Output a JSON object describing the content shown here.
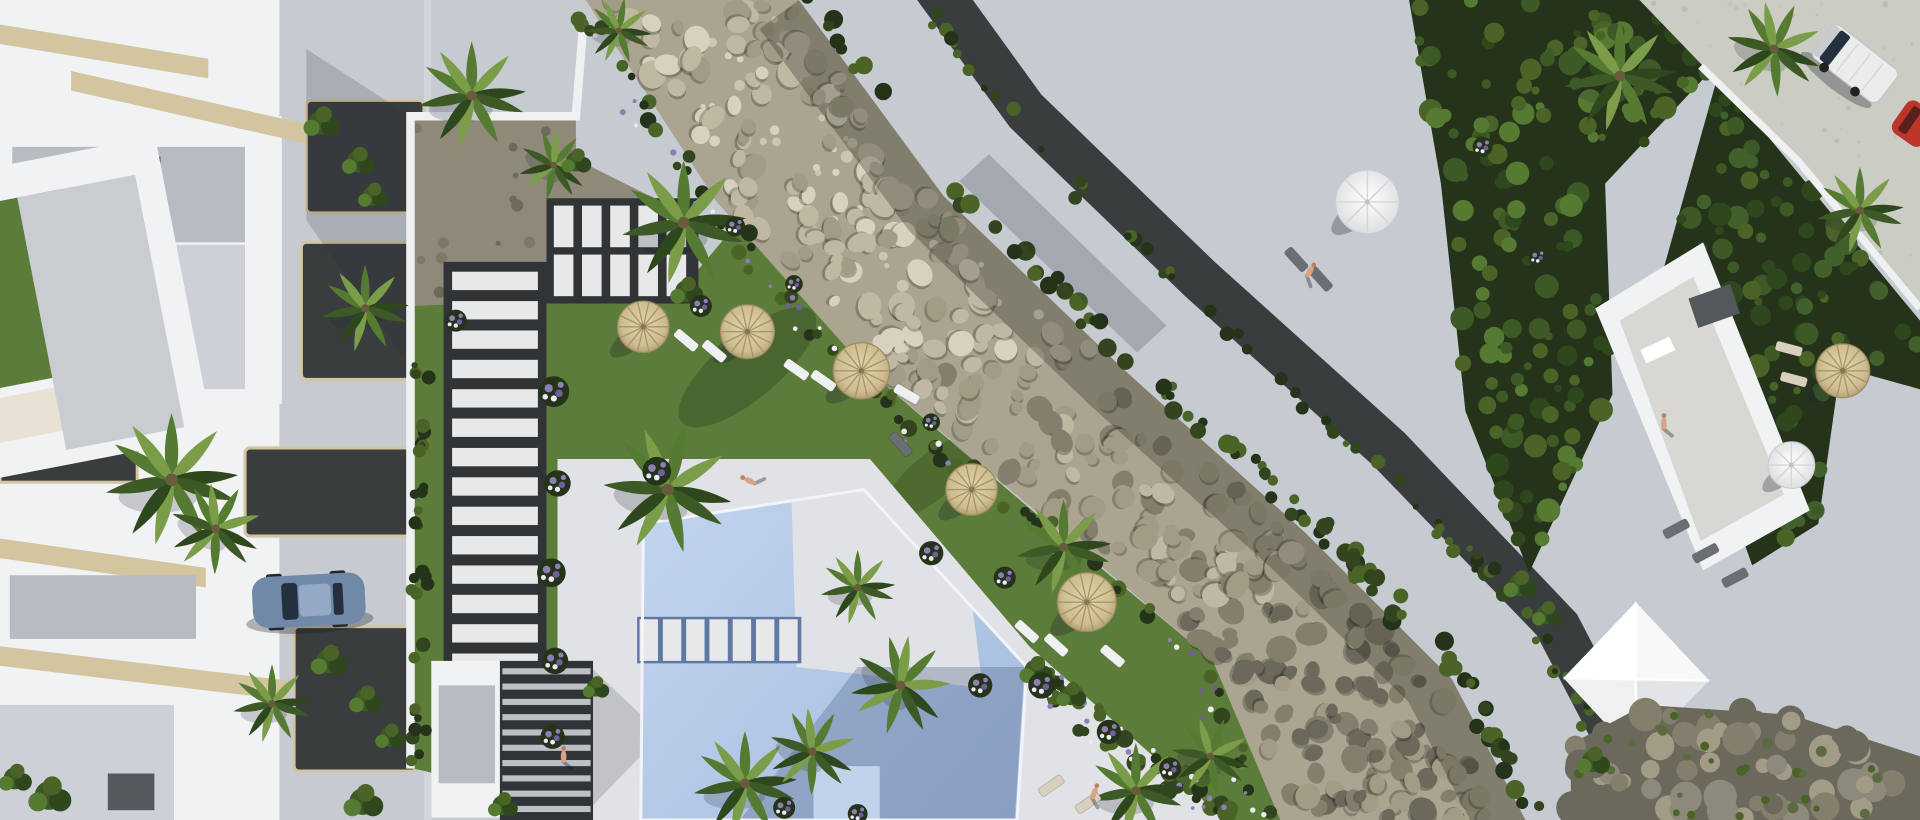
{
  "meta": {
    "title": "Aerial 3D render of a residential complex with communal pool, stone creek and roof-garden apartments",
    "type": "architectural-visualization",
    "visible_text": "none"
  },
  "palette": {
    "road": "#c6cad1",
    "paving": "#d2d5da",
    "roadWarm": "#cbccc4",
    "bedGravel": "#8f897a",
    "deck": "#e0e2e5",
    "deckShade": "#bfc3c9",
    "water": "#b5c9e6",
    "waterLight": "#cadcf0",
    "waterShadow": "#8ba3c8",
    "waterEdge": "#f1f4f8",
    "lawn": "#5c7c39",
    "lawnLight": "#6e9147",
    "lawnShade": "#42602b",
    "creekBase": "#aaa490",
    "stone1": "#d7d1bd",
    "stone2": "#bfb8a2",
    "stone3": "#a29b86",
    "stone4": "#847f6d",
    "stoneShade": "#6b685c",
    "hedge": "#33451f",
    "hedgeDark": "#24331a",
    "hedgeLight": "#4a6428",
    "moss": "#5c6b3f",
    "gravelDark": "#3a3d3e",
    "pathDark": "#303436",
    "slab": "#e7e8ea",
    "wall": "#f1f2f4",
    "wallShade": "#d8dbe0",
    "roofTile": "#b7bbc2",
    "roofLight": "#cdd1d7",
    "pebble": "#e7e2d3",
    "beige": "#d2c5a0",
    "strawTop": "#d8c99b",
    "strawRib": "#a8946a",
    "umbWhite": "#f4f5f3",
    "umbWhiteShade": "#d3d6da",
    "carBlue": "#7089a9",
    "carBlueLight": "#93a9c4",
    "glassDark": "#25303f",
    "vanBody": "#ebecec",
    "vanShade": "#c9cccd",
    "carRed": "#bb3629",
    "treeG1": "#3c5926",
    "treeG2": "#2e471d",
    "treeG3": "#557a31",
    "palmLight": "#7b9c49",
    "flowerPurple": "#8d7fb5",
    "flowerViolet": "#6f5f9c",
    "flowerWhite": "#eceaf2",
    "skin": "#d9a483",
    "shadow": "rgba(30,36,48,0.30)",
    "shadowSoft": "rgba(30,36,48,0.18)"
  },
  "scene": {
    "creek": {
      "left": [
        [
          478,
          0
        ],
        [
          585,
          165
        ],
        [
          705,
          300
        ],
        [
          860,
          430
        ],
        [
          990,
          540
        ],
        [
          1045,
          670
        ]
      ],
      "right": [
        [
          652,
          0
        ],
        [
          770,
          160
        ],
        [
          915,
          300
        ],
        [
          1065,
          435
        ],
        [
          1185,
          555
        ],
        [
          1245,
          670
        ]
      ]
    },
    "umbrellas_straw": [
      [
        525,
        267,
        21
      ],
      [
        610,
        271,
        22
      ],
      [
        703,
        303,
        23
      ],
      [
        793,
        400,
        21
      ],
      [
        887,
        492,
        24
      ],
      [
        1504,
        303,
        22
      ]
    ],
    "umbrellas_white": [
      [
        1116,
        165,
        26
      ],
      [
        1462,
        380,
        19
      ]
    ],
    "palms": [
      [
        385,
        78,
        1.3,
        0
      ],
      [
        452,
        135,
        0.85,
        40
      ],
      [
        505,
        25,
        0.8,
        10
      ],
      [
        558,
        182,
        1.5,
        0
      ],
      [
        545,
        400,
        1.55,
        15
      ],
      [
        868,
        447,
        1.15,
        0
      ],
      [
        608,
        640,
        1.25,
        0
      ],
      [
        663,
        614,
        1.05,
        30
      ],
      [
        927,
        646,
        1.15,
        0
      ],
      [
        988,
        618,
        0.95,
        20
      ],
      [
        1322,
        62,
        1.35,
        0
      ],
      [
        1448,
        40,
        1.15,
        25
      ],
      [
        1518,
        172,
        1.05,
        0
      ],
      [
        140,
        392,
        1.6,
        0
      ],
      [
        176,
        432,
        1.1,
        30
      ],
      [
        298,
        252,
        1.05,
        0
      ],
      [
        222,
        575,
        0.95,
        0
      ],
      [
        735,
        560,
        1.2,
        45
      ],
      [
        700,
        480,
        0.9,
        0
      ]
    ],
    "bushes": [
      [
        262,
        100,
        1.1
      ],
      [
        292,
        132,
        1.0
      ],
      [
        304,
        160,
        0.9
      ],
      [
        268,
        540,
        1.1
      ],
      [
        298,
        572,
        1.0
      ],
      [
        318,
        602,
        0.9
      ],
      [
        296,
        655,
        1.2
      ],
      [
        40,
        650,
        1.3
      ],
      [
        12,
        636,
        1.0
      ],
      [
        560,
        238,
        1.0
      ],
      [
        470,
        132,
        0.9
      ],
      [
        845,
        548,
        1.0
      ],
      [
        874,
        568,
        0.9
      ],
      [
        1240,
        478,
        1.0
      ],
      [
        1262,
        502,
        0.9
      ],
      [
        1300,
        622,
        1.0
      ],
      [
        486,
        562,
        0.8
      ],
      [
        410,
        658,
        0.9
      ]
    ],
    "flowerbeds": [
      [
        452,
        320,
        1.4
      ],
      [
        455,
        395,
        1.2
      ],
      [
        450,
        468,
        1.3
      ],
      [
        453,
        540,
        1.2
      ],
      [
        451,
        602,
        1.1
      ],
      [
        572,
        250,
        1.0
      ],
      [
        536,
        385,
        1.3
      ],
      [
        760,
        452,
        1.1
      ],
      [
        820,
        472,
        1.0
      ],
      [
        850,
        560,
        1.2
      ],
      [
        905,
        598,
        1.1
      ],
      [
        955,
        628,
        1.0
      ],
      [
        372,
        262,
        1.0
      ],
      [
        600,
        185,
        0.9
      ],
      [
        648,
        232,
        0.8
      ],
      [
        700,
        290,
        0.9
      ],
      [
        760,
        345,
        0.8
      ],
      [
        640,
        660,
        1.0
      ],
      [
        700,
        665,
        0.9
      ],
      [
        800,
        560,
        1.1
      ],
      [
        1210,
        120,
        0.9
      ],
      [
        1255,
        210,
        0.8
      ]
    ],
    "loungers": [
      [
        560,
        278,
        40,
        1
      ],
      [
        583,
        287,
        40,
        1
      ],
      [
        650,
        302,
        35,
        1
      ],
      [
        672,
        311,
        35,
        1
      ],
      [
        740,
        322,
        30,
        1
      ],
      [
        838,
        516,
        42,
        1
      ],
      [
        862,
        527,
        42,
        1
      ],
      [
        908,
        536,
        40,
        1
      ],
      [
        858,
        642,
        -35,
        0
      ],
      [
        888,
        656,
        -35,
        0
      ],
      [
        1058,
        212,
        48,
        2
      ],
      [
        1078,
        228,
        48,
        2
      ],
      [
        1460,
        285,
        15,
        0
      ],
      [
        1464,
        310,
        15,
        0
      ],
      [
        1368,
        432,
        -28,
        2
      ],
      [
        1392,
        452,
        -28,
        2
      ],
      [
        1416,
        472,
        -28,
        2
      ],
      [
        735,
        363,
        48,
        2
      ]
    ],
    "people": [
      [
        612,
        393,
        -65
      ],
      [
        460,
        618,
        0
      ],
      [
        893,
        648,
        20
      ],
      [
        1358,
        346,
        0
      ],
      [
        1069,
        222,
        30
      ]
    ],
    "vehicles": {
      "car_blue": {
        "x": 205,
        "y": 472,
        "angle": -3
      },
      "van_white": {
        "x": 1514,
        "y": 52,
        "angle": 38
      },
      "car_red_partial": {
        "x": 1557,
        "y": 97,
        "angle": 35
      }
    },
    "counts": {
      "creek_stones": 360,
      "tufts": 45,
      "hedge_right": 95,
      "hedge_left": 60,
      "hedge_walk": 70,
      "hedge_bottom": 45,
      "hedge_wallside": 35,
      "garden1": 160,
      "garden2": 110,
      "wall_stones": 70,
      "moss": 28,
      "bed_speckle": 22,
      "road_speckle": 36
    }
  }
}
